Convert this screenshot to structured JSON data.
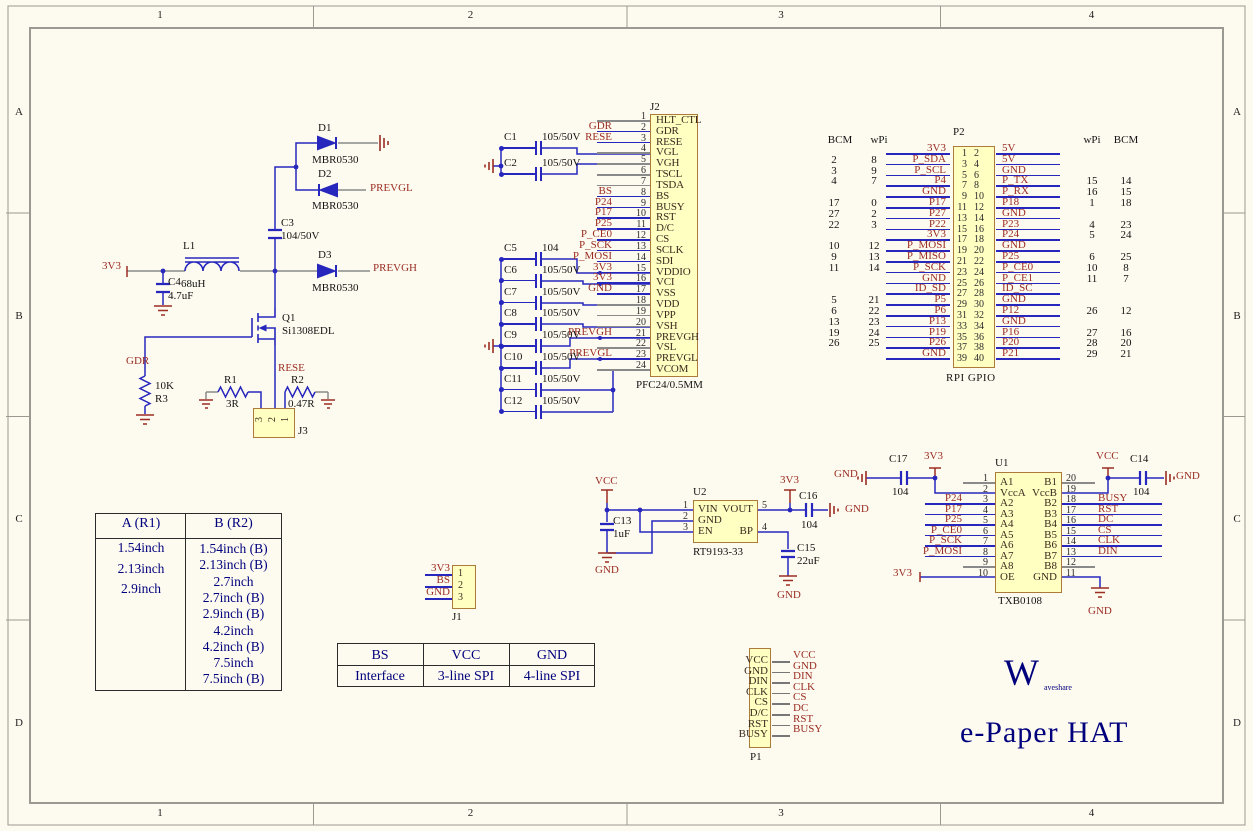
{
  "colors": {
    "wire_blue": "#2727bd",
    "net_maroon": "#9b2d23",
    "component_fill": "#ffffc2",
    "component_border": "#ad7b39",
    "sheet_bg": "#fdfaef",
    "table_navy": "#00007d"
  },
  "frame": {
    "cols": [
      {
        "t": "1"
      },
      {
        "t": "2"
      },
      {
        "t": "3"
      },
      {
        "t": "4"
      }
    ],
    "rows": [
      {
        "t": "A"
      },
      {
        "t": "B"
      },
      {
        "t": "C"
      },
      {
        "t": "D"
      }
    ]
  },
  "boost": {
    "v_in": "3V3",
    "c4_ref": "C4",
    "c4_val": "4.7uF",
    "l1_ref": "L1",
    "l1_val": "68uH",
    "c3_ref": "C3",
    "c3_val": "104/50V",
    "d1_ref": "D1",
    "d1_val": "MBR0530",
    "d2_ref": "D2",
    "d2_val": "MBR0530",
    "d3_ref": "D3",
    "d3_val": "MBR0530",
    "prevgl": "PREVGL",
    "prevgh": "PREVGH",
    "q1_ref": "Q1",
    "q1_val": "Si1308EDL",
    "gdr": "GDR",
    "rese": "RESE",
    "r3_ref": "R3",
    "r3_val": "10K",
    "r1_ref": "R1",
    "r1_val": "3R",
    "r2_ref": "R2",
    "r2_val": "0.47R",
    "j3_ref": "J3",
    "j3_pins": [
      {
        "n": "3"
      },
      {
        "n": "2"
      },
      {
        "n": "1"
      }
    ]
  },
  "j2": {
    "ref": "J2",
    "footer": "PFC24/0.5MM",
    "pins": [
      {
        "num": "1",
        "name": "HLT_CTL",
        "net": ""
      },
      {
        "num": "2",
        "name": "GDR",
        "net": "GDR"
      },
      {
        "num": "3",
        "name": "RESE",
        "net": "RESE"
      },
      {
        "num": "4",
        "name": "VGL",
        "net": ""
      },
      {
        "num": "5",
        "name": "VGH",
        "net": ""
      },
      {
        "num": "6",
        "name": "TSCL",
        "net": ""
      },
      {
        "num": "7",
        "name": "TSDA",
        "net": ""
      },
      {
        "num": "8",
        "name": "BS",
        "net": "BS"
      },
      {
        "num": "9",
        "name": "BUSY",
        "net": "P24"
      },
      {
        "num": "10",
        "name": "RST",
        "net": "P17"
      },
      {
        "num": "11",
        "name": "D/C",
        "net": "P25"
      },
      {
        "num": "12",
        "name": "CS",
        "net": "P_CE0"
      },
      {
        "num": "13",
        "name": "SCLK",
        "net": "P_SCK"
      },
      {
        "num": "14",
        "name": "SDI",
        "net": "P_MOSI"
      },
      {
        "num": "15",
        "name": "VDDIO",
        "net": "3V3"
      },
      {
        "num": "16",
        "name": "VCI",
        "net": "3V3"
      },
      {
        "num": "17",
        "name": "VSS",
        "net": "GND"
      },
      {
        "num": "18",
        "name": "VDD",
        "net": ""
      },
      {
        "num": "19",
        "name": "VPP",
        "net": ""
      },
      {
        "num": "20",
        "name": "VSH",
        "net": ""
      },
      {
        "num": "21",
        "name": "PREVGH",
        "net": "PREVGH"
      },
      {
        "num": "22",
        "name": "VSL",
        "net": ""
      },
      {
        "num": "23",
        "name": "PREVGL",
        "net": "PREVGL"
      },
      {
        "num": "24",
        "name": "VCOM",
        "net": ""
      }
    ]
  },
  "bank1": [
    {
      "ref": "C1",
      "val": "105/50V"
    },
    {
      "ref": "C2",
      "val": "105/50V"
    }
  ],
  "bank2": [
    {
      "ref": "C5",
      "val": "104"
    },
    {
      "ref": "C6",
      "val": "105/50V"
    },
    {
      "ref": "C7",
      "val": "105/50V"
    },
    {
      "ref": "C8",
      "val": "105/50V"
    },
    {
      "ref": "C9",
      "val": "105/50V"
    },
    {
      "ref": "C10",
      "val": "105/50V"
    },
    {
      "ref": "C11",
      "val": "105/50V"
    },
    {
      "ref": "C12",
      "val": "105/50V"
    }
  ],
  "p2": {
    "ref": "P2",
    "footer": "RPI GPIO",
    "hdr": {
      "bcm_l": "BCM",
      "wpi_l": "wPi",
      "wpi_r": "wPi",
      "bcm_r": "BCM"
    },
    "rows": [
      {
        "bl": "",
        "wl": "",
        "nl": "3V3",
        "po": "1",
        "pe": "2",
        "nr": "5V",
        "wr": "",
        "br": ""
      },
      {
        "bl": "2",
        "wl": "8",
        "nl": "P_SDA",
        "po": "3",
        "pe": "4",
        "nr": "5V",
        "wr": "",
        "br": ""
      },
      {
        "bl": "3",
        "wl": "9",
        "nl": "P_SCL",
        "po": "5",
        "pe": "6",
        "nr": "GND",
        "wr": "",
        "br": ""
      },
      {
        "bl": "4",
        "wl": "7",
        "nl": "P4",
        "po": "7",
        "pe": "8",
        "nr": "P_TX",
        "wr": "15",
        "br": "14"
      },
      {
        "bl": "",
        "wl": "",
        "nl": "GND",
        "po": "9",
        "pe": "10",
        "nr": "P_RX",
        "wr": "16",
        "br": "15"
      },
      {
        "bl": "17",
        "wl": "0",
        "nl": "P17",
        "po": "11",
        "pe": "12",
        "nr": "P18",
        "wr": "1",
        "br": "18"
      },
      {
        "bl": "27",
        "wl": "2",
        "nl": "P27",
        "po": "13",
        "pe": "14",
        "nr": "GND",
        "wr": "",
        "br": ""
      },
      {
        "bl": "22",
        "wl": "3",
        "nl": "P22",
        "po": "15",
        "pe": "16",
        "nr": "P23",
        "wr": "4",
        "br": "23"
      },
      {
        "bl": "",
        "wl": "",
        "nl": "3V3",
        "po": "17",
        "pe": "18",
        "nr": "P24",
        "wr": "5",
        "br": "24"
      },
      {
        "bl": "10",
        "wl": "12",
        "nl": "P_MOSI",
        "po": "19",
        "pe": "20",
        "nr": "GND",
        "wr": "",
        "br": ""
      },
      {
        "bl": "9",
        "wl": "13",
        "nl": "P_MISO",
        "po": "21",
        "pe": "22",
        "nr": "P25",
        "wr": "6",
        "br": "25"
      },
      {
        "bl": "11",
        "wl": "14",
        "nl": "P_SCK",
        "po": "23",
        "pe": "24",
        "nr": "P_CE0",
        "wr": "10",
        "br": "8"
      },
      {
        "bl": "",
        "wl": "",
        "nl": "GND",
        "po": "25",
        "pe": "26",
        "nr": "P_CE1",
        "wr": "11",
        "br": "7"
      },
      {
        "bl": "",
        "wl": "",
        "nl": "ID_SD",
        "po": "27",
        "pe": "28",
        "nr": "ID_SC",
        "wr": "",
        "br": ""
      },
      {
        "bl": "5",
        "wl": "21",
        "nl": "P5",
        "po": "29",
        "pe": "30",
        "nr": "GND",
        "wr": "",
        "br": ""
      },
      {
        "bl": "6",
        "wl": "22",
        "nl": "P6",
        "po": "31",
        "pe": "32",
        "nr": "P12",
        "wr": "26",
        "br": "12"
      },
      {
        "bl": "13",
        "wl": "23",
        "nl": "P13",
        "po": "33",
        "pe": "34",
        "nr": "GND",
        "wr": "",
        "br": ""
      },
      {
        "bl": "19",
        "wl": "24",
        "nl": "P19",
        "po": "35",
        "pe": "36",
        "nr": "P16",
        "wr": "27",
        "br": "16"
      },
      {
        "bl": "26",
        "wl": "25",
        "nl": "P26",
        "po": "37",
        "pe": "38",
        "nr": "P20",
        "wr": "28",
        "br": "20"
      },
      {
        "bl": "",
        "wl": "",
        "nl": "GND",
        "po": "39",
        "pe": "40",
        "nr": "P21",
        "wr": "29",
        "br": "21"
      }
    ]
  },
  "u2": {
    "ref": "U2",
    "part": "RT9193-33",
    "left": [
      {
        "num": "1",
        "name": "VIN"
      },
      {
        "num": "2",
        "name": "GND"
      },
      {
        "num": "3",
        "name": "EN"
      }
    ],
    "right": [
      {
        "num": "5",
        "name": "VOUT"
      },
      {
        "num": "4",
        "name": "BP"
      }
    ],
    "vcc": "VCC",
    "gnd_in": "GND",
    "v3": "3V3",
    "gnd_c16": "GND",
    "gnd_c15": "GND",
    "c13_ref": "C13",
    "c13_val": "1uF",
    "c15_ref": "C15",
    "c15_val": "22uF",
    "c16_ref": "C16",
    "c16_val": "104"
  },
  "u1": {
    "ref": "U1",
    "part": "TXB0108",
    "left": [
      {
        "num": "1",
        "name": "A1",
        "net": ""
      },
      {
        "num": "2",
        "name": "VccA",
        "net": "",
        "xw": 1
      },
      {
        "num": "3",
        "name": "A2",
        "net": "P24"
      },
      {
        "num": "4",
        "name": "A3",
        "net": "P17"
      },
      {
        "num": "5",
        "name": "A4",
        "net": "P25"
      },
      {
        "num": "6",
        "name": "A5",
        "net": "P_CE0"
      },
      {
        "num": "7",
        "name": "A6",
        "net": "P_SCK"
      },
      {
        "num": "8",
        "name": "A7",
        "net": "P_MOSI"
      },
      {
        "num": "9",
        "name": "A8",
        "net": ""
      },
      {
        "num": "10",
        "name": "OE",
        "net": "",
        "xw": 1
      }
    ],
    "right": [
      {
        "num": "20",
        "name": "B1",
        "net": ""
      },
      {
        "num": "19",
        "name": "VccB",
        "net": "",
        "xw": 1
      },
      {
        "num": "18",
        "name": "B2",
        "net": "BUSY"
      },
      {
        "num": "17",
        "name": "B3",
        "net": "RST"
      },
      {
        "num": "16",
        "name": "B4",
        "net": "DC"
      },
      {
        "num": "15",
        "name": "B5",
        "net": "CS"
      },
      {
        "num": "14",
        "name": "B6",
        "net": "CLK"
      },
      {
        "num": "13",
        "name": "B7",
        "net": "DIN"
      },
      {
        "num": "12",
        "name": "B8",
        "net": ""
      },
      {
        "num": "11",
        "name": "GND",
        "net": "",
        "xw": 1
      }
    ],
    "c17_ref": "C17",
    "c17_val": "104",
    "c14_ref": "C14",
    "c14_val": "104",
    "gnd_l": "GND",
    "v3_a": "3V3",
    "vcc": "VCC",
    "gnd_r": "GND",
    "gnd_b": "GND",
    "v3_oe": "3V3"
  },
  "j1": {
    "ref": "J1",
    "rows": [
      {
        "num": "1",
        "net": "3V3"
      },
      {
        "num": "2",
        "net": "BS"
      },
      {
        "num": "3",
        "net": "GND"
      }
    ]
  },
  "p1": {
    "ref": "P1",
    "rows": [
      {
        "name": "VCC",
        "net": "VCC"
      },
      {
        "name": "GND",
        "net": "GND"
      },
      {
        "name": "DIN",
        "net": "DIN"
      },
      {
        "name": "CLK",
        "net": "CLK"
      },
      {
        "name": "CS",
        "net": "CS"
      },
      {
        "name": "D/C",
        "net": "DC"
      },
      {
        "name": "RST",
        "net": "RST"
      },
      {
        "name": "BUSY",
        "net": "BUSY"
      }
    ]
  },
  "size_table": {
    "col_a_header": "A (R1)",
    "col_b_header": "B (R2)",
    "col_a": [
      {
        "t": "1.54inch"
      },
      {
        "t": "2.13inch"
      },
      {
        "t": "2.9inch"
      }
    ],
    "col_b": [
      {
        "t": "1.54inch (B)"
      },
      {
        "t": "2.13inch (B)"
      },
      {
        "t": "2.7inch"
      },
      {
        "t": "2.7inch (B)"
      },
      {
        "t": "2.9inch (B)"
      },
      {
        "t": "4.2inch"
      },
      {
        "t": "4.2inch (B)"
      },
      {
        "t": "7.5inch"
      },
      {
        "t": "7.5inch (B)"
      }
    ]
  },
  "bs_table": {
    "row1": [
      {
        "t": "BS"
      },
      {
        "t": "VCC"
      },
      {
        "t": "GND"
      }
    ],
    "row2": [
      {
        "t": "Interface"
      },
      {
        "t": "3-line SPI"
      },
      {
        "t": "4-line SPI"
      }
    ]
  },
  "brand": {
    "w": "W",
    "rest": "aveshare",
    "title": "e-Paper HAT"
  }
}
